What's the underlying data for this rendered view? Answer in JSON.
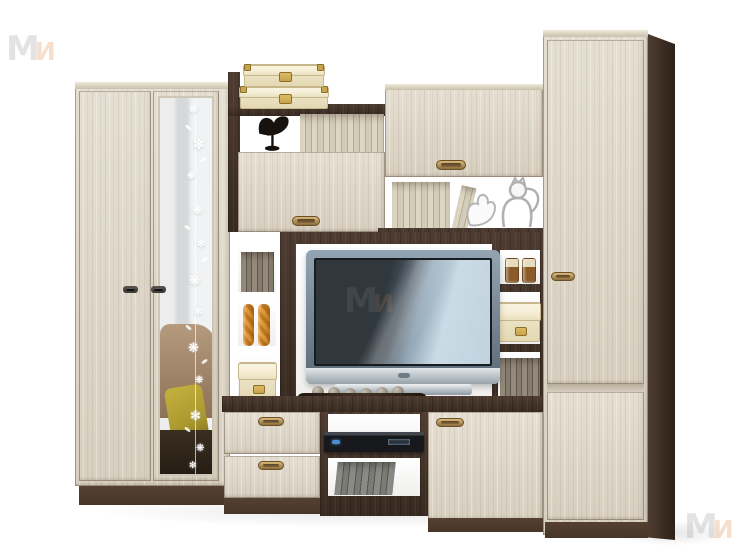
{
  "meta": {
    "type": "product-photograph",
    "subject": "living-room wall unit (entertainment centre) with TV, two-tone ash wood",
    "background": "#ffffff"
  },
  "palette": {
    "wood_light": "#d7cfc0",
    "wood_light_hi": "#e5dfd2",
    "wood_dark": "#4e3c31",
    "wood_dark_deep": "#382a20",
    "plinth": "#463529",
    "handle_bronze_hi": "#d9b97a",
    "handle_bronze": "#8d6d3c",
    "handle_bronze_edge": "#6a5128",
    "handle_dark": "#3c3835",
    "box_cream": "#f2ecd4",
    "box_cream_deep": "#e3d8b2",
    "box_edge": "#c6b88c",
    "clasp_gold": "#c7a44e",
    "candle_a": "#e29a3c",
    "candle_b": "#c07a20",
    "book_cream_a": "#ddd6c2",
    "book_cream_b": "#b2ab94",
    "book_gray_a": "#94897a",
    "book_gray_b": "#5f584c",
    "book_blue_a": "#8a8a86",
    "book_blue_b": "#55544f",
    "mirror_light": "#f1f2f3",
    "mirror_gray": "#d7d8d9",
    "sofa_brown": "#8d7158",
    "sofa_brown_hi": "#b59a7e",
    "pillow_olive": "#ac992f",
    "sofa_dark": "#3a2e21",
    "tv_frame_hi": "#93a4b3",
    "tv_frame": "#5a6977",
    "screen_dark": "#30383e",
    "screen_mid": "#8fa5b5",
    "screen_light": "#cbdbe6",
    "silver_hi": "#e2e7ea",
    "silver": "#97a2aa",
    "dvd_dark": "#16181b",
    "bowl_dark": "#221810",
    "ball_hi": "#c9c3b6",
    "ball": "#8b8578",
    "jar_amber": "#8a5a28",
    "jar_cream": "#e7dbbd",
    "wm_gray": "#a5a5a5",
    "wm_orange": "#e8965a"
  },
  "watermark": {
    "letter_m": "М",
    "letter_i": "И"
  },
  "furniture": {
    "wardrobe": {
      "doors": 2,
      "right_door": "mirror with white floral vine decor",
      "handles": "dark metal bars"
    },
    "flap_cabinet": {
      "handle": "bronze oval"
    },
    "wall_cabinet": {
      "handle": "bronze oval"
    },
    "tv_niche": {
      "back": "white",
      "frame": "dark ash"
    },
    "drawers": {
      "count": 2,
      "handles": "bronze oval"
    },
    "media_shelf": {
      "device": "dvd-player",
      "lower": "books"
    },
    "lower_cabinet_door": {
      "handle": "bronze oval"
    },
    "tall_cabinet": {
      "doors": 2,
      "handle": "bronze oval",
      "side_panel": "dark ash"
    }
  },
  "decor": {
    "stacked_boxes": {
      "count": 2,
      "style": "ivory with gold corners and label plate"
    },
    "bird_sculpture": {
      "color": "black"
    },
    "top_book_row": "cream book spines",
    "leaning_books": "beige book spines",
    "cat_figurines": {
      "count": 2,
      "style": "white wire"
    },
    "left_column": [
      "gray books",
      "two orange twisted candles",
      "ivory storage box"
    ],
    "right_column": [
      "two amber candle jars",
      "ivory storage box",
      "dark books"
    ],
    "bowl_with_stones": {
      "stones": 6,
      "bowl": "dark wood boat"
    },
    "mirror_vine": {
      "flower": "❋",
      "flower_small": "✻"
    }
  }
}
